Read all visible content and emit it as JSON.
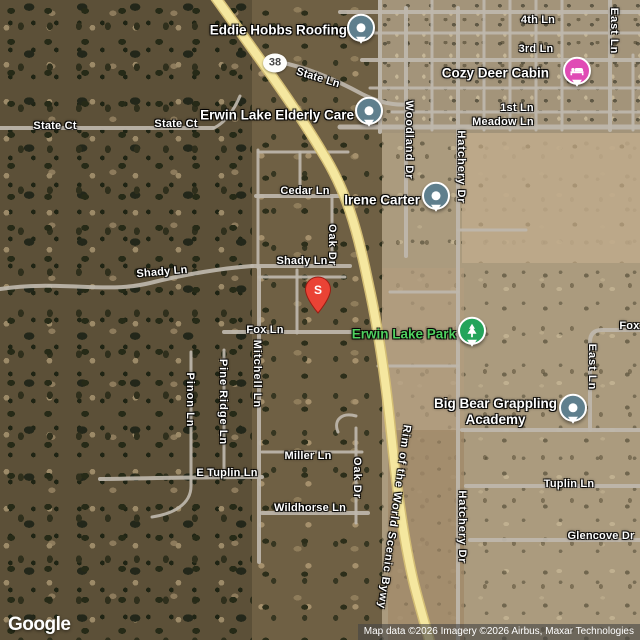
{
  "attribution": {
    "logo": "Google",
    "credits": "Map data ©2026 Imagery ©2026 Airbus, Maxar Technologies"
  },
  "route_shield": {
    "number": "38"
  },
  "marker_s": {
    "label": "S"
  },
  "colors": {
    "poi_pin": "#5f7f8d",
    "lodging_pin": "#e04bb5",
    "park_pin": "#23a45a",
    "park_label": "#4fd05f",
    "red_marker": "#ea4335",
    "highway": "#f5e79f"
  },
  "streets": [
    {
      "text": "State Ln"
    },
    {
      "text": "4th Ln"
    },
    {
      "text": "East Ln"
    },
    {
      "text": "3rd Ln"
    },
    {
      "text": "1st Ln"
    },
    {
      "text": "Meadow Ln"
    },
    {
      "text": "State Ct"
    },
    {
      "text": "State Ct"
    },
    {
      "text": "Woodland Dr"
    },
    {
      "text": "Hatchery Dr"
    },
    {
      "text": "Cedar Ln"
    },
    {
      "text": "Oak Dr"
    },
    {
      "text": "Shady Ln"
    },
    {
      "text": "Shady Ln"
    },
    {
      "text": "Fox Ln"
    },
    {
      "text": "Fox Ln"
    },
    {
      "text": "Mitchell Ln"
    },
    {
      "text": "Pinon Ln"
    },
    {
      "text": "Pine Ridge Ln"
    },
    {
      "text": "Miller Ln"
    },
    {
      "text": "E Tuplin Ln"
    },
    {
      "text": "Oak Dr"
    },
    {
      "text": "Wildhorse Ln"
    },
    {
      "text": "Tuplin Ln"
    },
    {
      "text": "Glencove Dr"
    },
    {
      "text": "East Ln"
    },
    {
      "text": "Rim of the World Scenic Bywy"
    },
    {
      "text": "Hatchery Dr"
    }
  ],
  "pois": [
    {
      "name": "Eddie Hobbs Roofing",
      "type": "business"
    },
    {
      "name": "Erwin Lake Elderly Care",
      "type": "business"
    },
    {
      "name": "Cozy Deer Cabin",
      "type": "lodging"
    },
    {
      "name": "Irene Carter",
      "type": "business"
    },
    {
      "name": "Erwin Lake Park",
      "type": "park"
    },
    {
      "name": "Big Bear Grappling Academy",
      "line1": "Big Bear Grappling",
      "line2": "Academy",
      "type": "business"
    }
  ]
}
